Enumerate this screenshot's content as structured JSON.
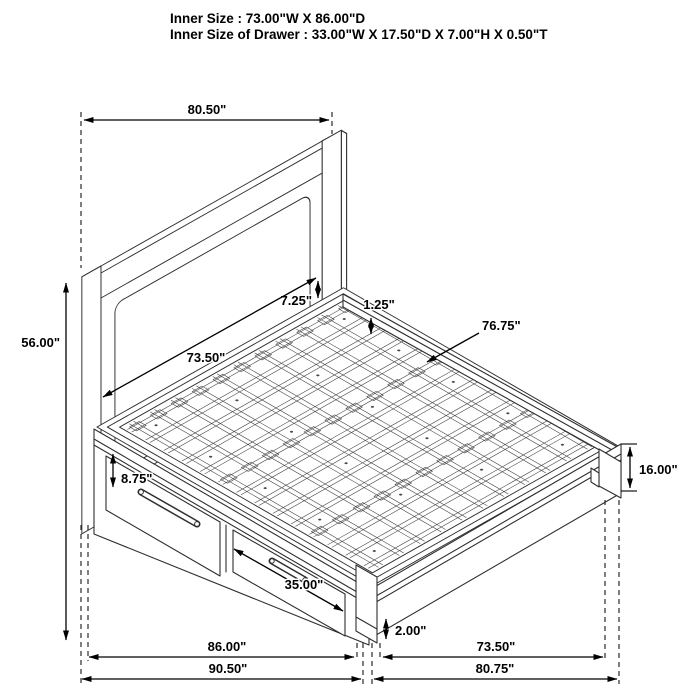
{
  "title": {
    "line1": "Inner Size : 73.00\"W X 86.00\"D",
    "line2": "Inner Size of Drawer : 33.00\"W X 17.50\"D X 7.00\"H X 0.50\"T"
  },
  "dimensions": {
    "headboard_width": "80.50\"",
    "headboard_height": "56.00\"",
    "rail_to_deck_height": "7.25\"",
    "slat_thickness": "1.25\"",
    "side_rail_length": "76.75\"",
    "inner_width": "73.50\"",
    "drawer_front_height": "8.75\"",
    "footboard_height": "16.00\"",
    "drawer_front_width": "35.00\"",
    "foot_clearance": "2.00\"",
    "inner_depth": "86.00\"",
    "overall_depth": "90.50\"",
    "footboard_inner_width": "73.50\"",
    "footboard_overall_width": "80.75\""
  }
}
